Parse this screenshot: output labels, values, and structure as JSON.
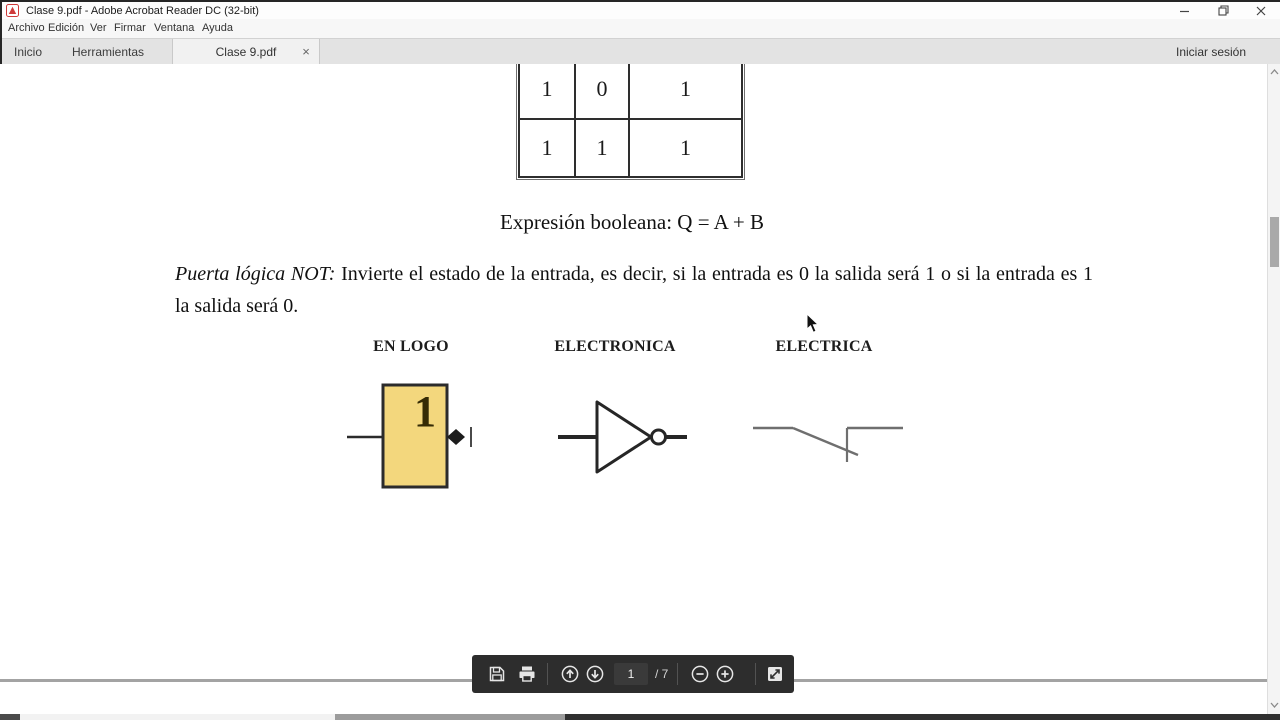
{
  "window": {
    "title": "Clase 9.pdf - Adobe Acrobat Reader DC (32-bit)"
  },
  "menu": {
    "items": [
      "Archivo",
      "Edición",
      "Ver",
      "Firmar",
      "Ventana",
      "Ayuda"
    ]
  },
  "tab_bar": {
    "home": "Inicio",
    "tools": "Herramientas",
    "document": "Clase 9.pdf",
    "sign_in": "Iniciar sesión"
  },
  "icons": {
    "help": "?",
    "tab_close": "×"
  },
  "document": {
    "truth_table": {
      "rows": [
        [
          "1",
          "0",
          "1"
        ],
        [
          "1",
          "1",
          "1"
        ]
      ]
    },
    "boolean_expression": "Expresión booleana: Q = A + B",
    "not_gate_paragraph": {
      "lead": "Puerta lógica NOT:",
      "body": " Invierte el estado de la entrada, es decir, si la entrada es 0 la salida será 1 o si la entrada es 1 la salida será 0."
    },
    "symbol_columns": [
      "EN LOGO",
      "ELECTRONICA",
      "ELECTRICA"
    ],
    "logo_symbol_label": "1"
  },
  "page_toolbar": {
    "page_number": "1",
    "page_total": "/ 7"
  },
  "colors": {
    "logo_block_fill": "#f3d77d",
    "toolbar_bg": "#2d2d2d",
    "adobe_red": "#cf3a3a",
    "page_endline": "#a3a3a3"
  }
}
